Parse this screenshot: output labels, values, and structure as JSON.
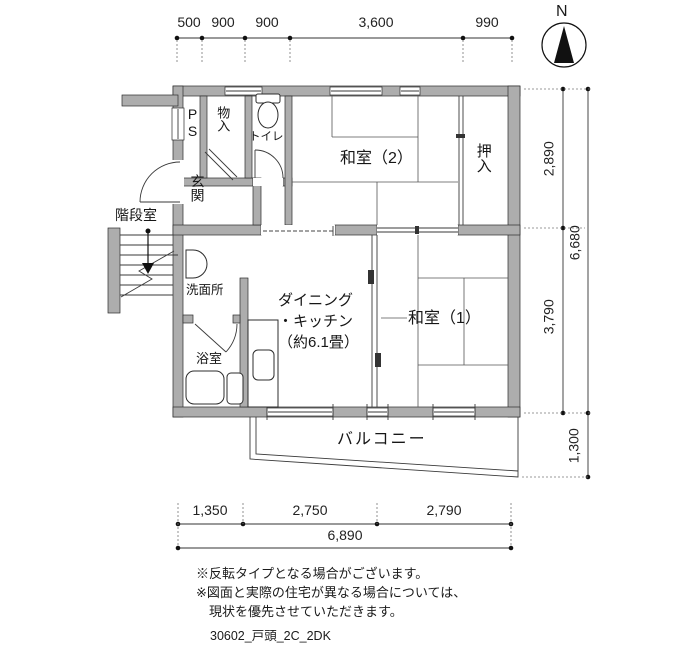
{
  "compass": {
    "north_label": "N"
  },
  "dimensions": {
    "top": [
      "500",
      "900",
      "900",
      "3,600",
      "990"
    ],
    "right": {
      "upper": "2,890",
      "lower": "3,790",
      "total": "6,680",
      "balcony": "1,300"
    },
    "bottom": {
      "segments": [
        "1,350",
        "2,750",
        "2,790"
      ],
      "total": "6,890"
    }
  },
  "rooms": {
    "washitsu2": "和室（2）",
    "washitsu1": "和室（1）",
    "oshiire": "押入",
    "monoire": "物入",
    "ps": "PS",
    "toilet": "トイレ",
    "genkan": "玄関",
    "stairwell": "階段室",
    "washroom": "洗面所",
    "bathroom": "浴室",
    "dining_kitchen": "ダイニング\n・キッチン\n（約6.1畳）",
    "balcony": "バルコニー"
  },
  "notes": "※反転タイプとなる場合がございます。\n※図面と実際の住宅が異なる場合については、\n　現状を優先させていただきます。",
  "footer": {
    "plan_code": "30602_戸頭_2C_2DK"
  },
  "colors": {
    "wall": "#adadad",
    "line": "#1a1a1a"
  }
}
